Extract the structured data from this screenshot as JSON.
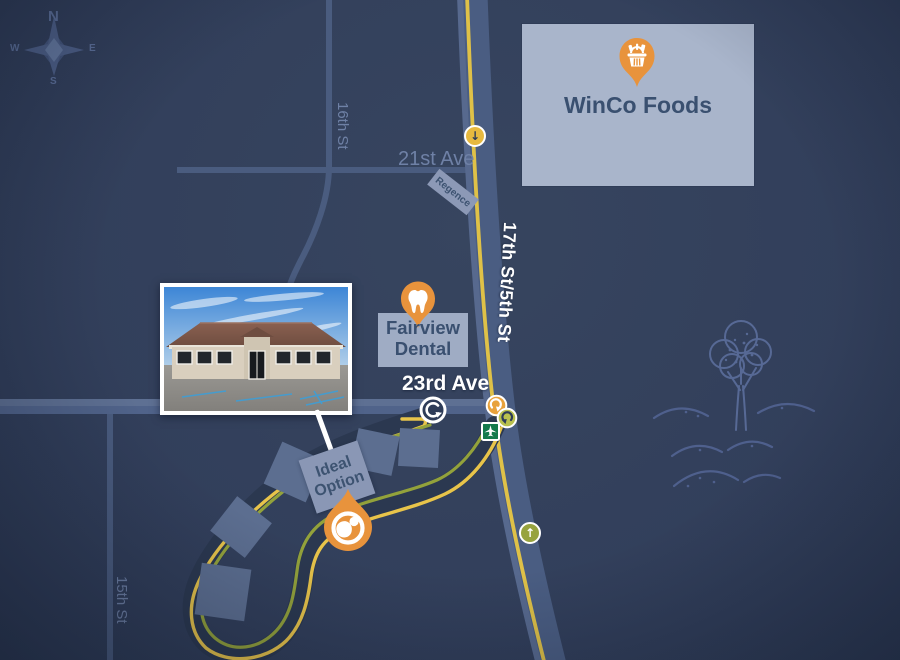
{
  "map": {
    "compass": {
      "n": "N",
      "e": "E",
      "s": "S",
      "w": "W"
    },
    "streets": {
      "highway": "17th St/5th St",
      "ave23": "23rd Ave",
      "ave21": "21st Ave",
      "st16": "16th St",
      "st15": "15th St"
    },
    "places": {
      "winco": {
        "name": "WinCo Foods"
      },
      "fairview": {
        "line1": "Fairview",
        "line2": "Dental"
      },
      "ideal_option": {
        "line1": "Ideal",
        "line2": "Option"
      },
      "regence": {
        "name": "Regence"
      }
    },
    "icons": {
      "winco_pin": "grocery-basket-pin",
      "fairview_pin": "tooth-pin",
      "ideal_marker": "ideal-option-droplet-marker",
      "roundabout": "roundabout-arrow",
      "signal_orange": "curved-arrow-signal",
      "signal_olive": "curved-arrow-signal",
      "arrow_down": "down-arrow-dot",
      "arrow_up": "up-arrow-dot",
      "airport": "airplane-sign",
      "compass": "compass-rose",
      "tree": "tree-sketch",
      "dunes": "dune-waves-sketch"
    },
    "colors": {
      "background": "#32405d",
      "accent_orange": "#e8933c",
      "route_yellow": "#e8c44a",
      "route_olive": "#93a23b",
      "building_light": "#a9b5cb",
      "building_mid": "#5c6e90",
      "road_slate": "#4a5d82",
      "label_dark": "#3a5070",
      "street_muted": "#6f81a6",
      "sign_green": "#147a4c",
      "street_white": "#ffffff"
    }
  }
}
